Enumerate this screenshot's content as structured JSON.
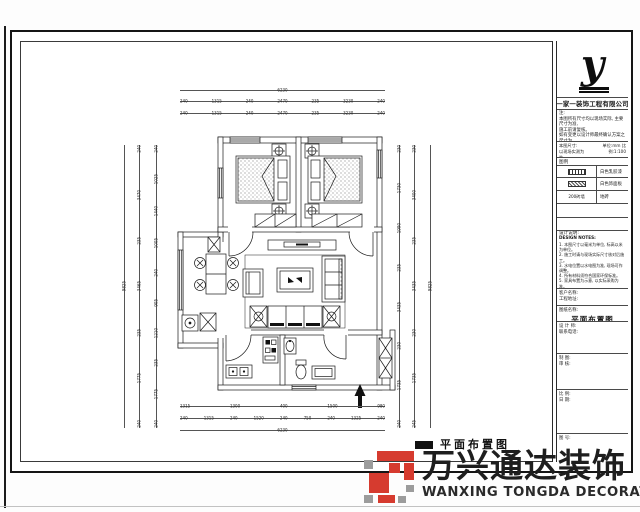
{
  "sheet": {
    "drawing_title": "平面布置图"
  },
  "titleblock": {
    "logo_letter": "y",
    "company_name": "一家一装饰工程有限公司",
    "notes_lines": [
      "注:",
      "  本图所有尺寸均以现场实际, 主要尺寸为准,",
      "施工前请复核。",
      "  如有变更以设计师最终确认方案之尺寸为",
      "准。"
    ],
    "info_left_lines": [
      "本图尺寸:",
      "以现场实测为准."
    ],
    "info_right": "单位:mm  比例:1:100",
    "legend_title": "图例",
    "legend_rows": [
      {
        "label": "白色乳胶漆"
      },
      {
        "label": "白色饰面板"
      },
      {
        "label": "地砖"
      }
    ],
    "legend_row3_icon_text": "200砖墙",
    "design_notes_title": "设计说明:",
    "design_notes_subtitle": "DESIGN NOTES:",
    "design_notes_lines": [
      "1. 本图尺寸以毫米为单位, 标高以米为单位。",
      "2. 施工时请与现场实际尺寸核对后施工。",
      "3. 水电位置以水电图为准, 现场可作调整。",
      "4. 所有材料须符合国家环保标准。",
      "5. 家具布置为示意, 以实际采购为准。",
      "6. 未尽事宜参照国家施工验收规范执行。"
    ],
    "fields": [
      {
        "label": "客户名称:",
        "label2": "工程地址:",
        "value": ""
      },
      {
        "label": "图纸名称:",
        "label2": "",
        "value": "平面布置图"
      },
      {
        "label": "设 计 师:",
        "label2": "联系电话:",
        "value": ""
      },
      {
        "label": "制 图:",
        "label2": "审 核:",
        "value": ""
      },
      {
        "label": "比 例:",
        "label2": "日 期:",
        "value": ""
      },
      {
        "label": "图 号:",
        "label2": "",
        "value": ""
      }
    ]
  },
  "dims": {
    "top_overall": "6230",
    "top_row1": [
      "240",
      "1315",
      "240",
      "2470",
      "235",
      "3230",
      "240"
    ],
    "top_row2": [
      "240",
      "1315",
      "240",
      "2470",
      "235",
      "3230",
      "240"
    ],
    "left_overall": "9825",
    "left_outer": [
      "240",
      "3470",
      "235",
      "3465",
      "235",
      "1775",
      "240"
    ],
    "left_inner": [
      "240",
      "1025",
      "1440",
      "1005",
      "240",
      "905",
      "1210",
      "235",
      "1775",
      "240"
    ],
    "right_inner": [
      "230",
      "1730",
      "1990",
      "235",
      "3435",
      "230",
      "1735",
      "240"
    ],
    "right_outer": [
      "230",
      "3400",
      "235",
      "3435",
      "230",
      "1735",
      "245"
    ],
    "right_overall": "9825",
    "bottom_row1": [
      "1315",
      "1300",
      "400",
      "1500",
      "980"
    ],
    "bottom_row2": [
      "240",
      "1315",
      "240",
      "1520",
      "240",
      "750",
      "240",
      "1325",
      "240"
    ],
    "bottom_overall": "6230"
  },
  "watermark": {
    "cn": "万兴通达装饰",
    "en": "WANXING TONGDA DECORATION",
    "red": "#d63b2f",
    "gray": "#9c9c9c"
  }
}
